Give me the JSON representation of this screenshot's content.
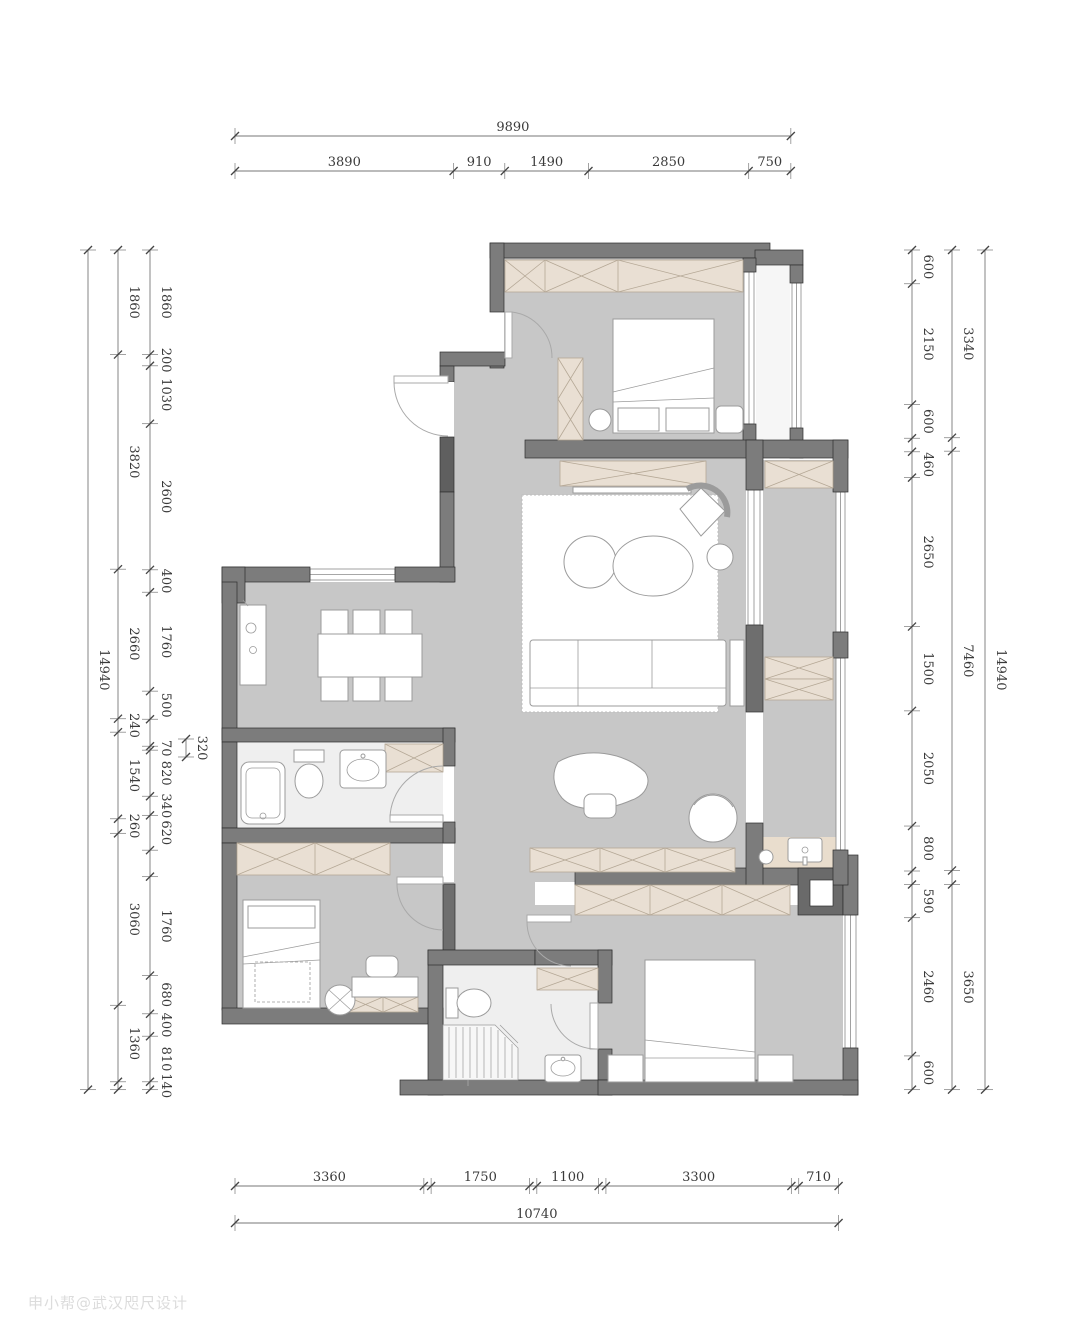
{
  "meta": {
    "watermark": "申小帮@武汉咫尺设计"
  },
  "palette": {
    "wall": "#7c7c7c",
    "wall_dark": "#5f5f5f",
    "wall_stroke": "#2e2e2e",
    "floor": "#c7c7c7",
    "floor_wet": "#efefef",
    "cabinet": "#e9dfd3",
    "cabinet_stroke": "#b5a896",
    "furniture_stroke": "#9b9b9b",
    "dim_text": "#3a3a3a",
    "dim_line": "#8a8a8a"
  },
  "dimensions": {
    "scale_px_per_mm": 0.0562,
    "chains": [
      {
        "id": "top-overall",
        "orient": "h",
        "axis": 136,
        "start": 235,
        "entries": [
          {
            "v": 9890
          }
        ]
      },
      {
        "id": "top-segments",
        "orient": "h",
        "axis": 171,
        "start": 235,
        "entries": [
          {
            "v": 3890
          },
          {
            "v": 910
          },
          {
            "v": 1490
          },
          {
            "v": 2850
          },
          {
            "v": 750
          }
        ]
      },
      {
        "id": "bottom-segments",
        "orient": "h",
        "axis": 1186,
        "start": 235,
        "entries": [
          {
            "v": 3360
          },
          {
            "g": 130
          },
          {
            "v": 1750
          },
          {
            "g": 130
          },
          {
            "v": 1100
          },
          {
            "g": 130
          },
          {
            "v": 3300
          },
          {
            "g": 130
          },
          {
            "v": 710
          }
        ]
      },
      {
        "id": "bottom-overall",
        "orient": "h",
        "axis": 1223,
        "start": 235,
        "entries": [
          {
            "v": 10740
          }
        ]
      },
      {
        "id": "left-overall",
        "orient": "v",
        "axis": 88,
        "start": 250,
        "entries": [
          {
            "v": 14940
          }
        ]
      },
      {
        "id": "left-outer",
        "orient": "v",
        "axis": 118,
        "start": 250,
        "entries": [
          {
            "v": 1860
          },
          {
            "v": 3820
          },
          {
            "v": 2660
          },
          {
            "v": 240
          },
          {
            "v": 1540
          },
          {
            "v": 260
          },
          {
            "v": 3060
          },
          {
            "v": 1360
          },
          {
            "g": 140
          }
        ]
      },
      {
        "id": "left-inner",
        "orient": "v",
        "axis": 150,
        "start": 250,
        "entries": [
          {
            "v": 1860
          },
          {
            "v": 200
          },
          {
            "v": 1030
          },
          {
            "v": 2600
          },
          {
            "v": 400
          },
          {
            "v": 1760
          },
          {
            "v": 500
          },
          {
            "g": 480
          },
          {
            "v": 70
          },
          {
            "v": 820
          },
          {
            "v": 340
          },
          {
            "v": 620
          },
          {
            "g": 470
          },
          {
            "v": 1760
          },
          {
            "v": 680
          },
          {
            "v": 400
          },
          {
            "v": 810
          },
          {
            "v": 140
          }
        ]
      },
      {
        "id": "left-niche",
        "orient": "v",
        "axis": 186,
        "start": 739,
        "entries": [
          {
            "v": 320
          }
        ]
      },
      {
        "id": "right-inner",
        "orient": "v",
        "axis": 912,
        "start": 250,
        "entries": [
          {
            "v": 600
          },
          {
            "v": 2150
          },
          {
            "v": 600
          },
          {
            "g": 240
          },
          {
            "v": 460
          },
          {
            "v": 2650
          },
          {
            "v": 1500
          },
          {
            "v": 2050
          },
          {
            "v": 800
          },
          {
            "g": 240
          },
          {
            "v": 590
          },
          {
            "v": 2460
          },
          {
            "v": 600
          }
        ]
      },
      {
        "id": "right-outer",
        "orient": "v",
        "axis": 952,
        "start": 250,
        "entries": [
          {
            "v": 3340
          },
          {
            "g": 240
          },
          {
            "v": 7460
          },
          {
            "g": 250
          },
          {
            "v": 3650
          }
        ]
      },
      {
        "id": "right-overall",
        "orient": "v",
        "axis": 985,
        "start": 250,
        "entries": [
          {
            "v": 14940
          }
        ]
      }
    ]
  }
}
